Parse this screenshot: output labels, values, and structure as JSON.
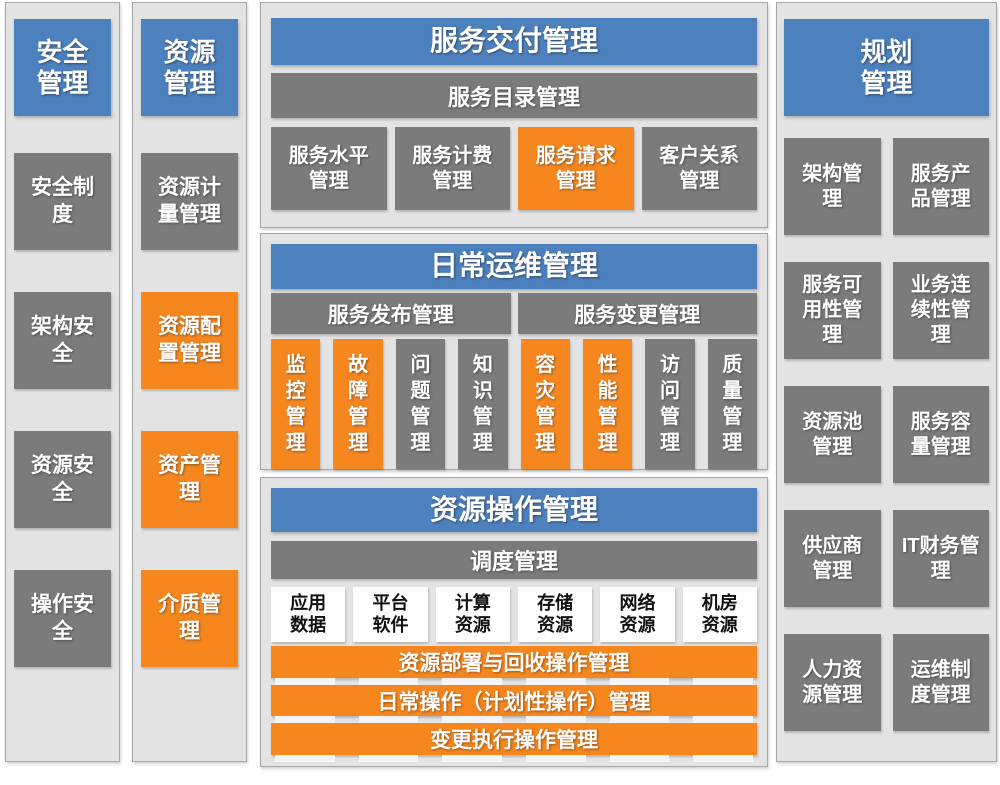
{
  "colors": {
    "blue": "#4D81BE",
    "orange": "#F6871F",
    "gray": "#7B7B7B",
    "panel_bg": "#E3E3E3",
    "panel_border": "#A6A6A6"
  },
  "security": {
    "header": "安全管理",
    "items": [
      {
        "label": "安全制度",
        "color": "gray"
      },
      {
        "label": "架构安全",
        "color": "gray"
      },
      {
        "label": "资源安全",
        "color": "gray"
      },
      {
        "label": "操作安全",
        "color": "gray"
      }
    ]
  },
  "resource": {
    "header": "资源管理",
    "items": [
      {
        "label": "资源计量管理",
        "color": "gray"
      },
      {
        "label": "资源配置管理",
        "color": "orange"
      },
      {
        "label": "资产管理",
        "color": "orange"
      },
      {
        "label": "介质管理",
        "color": "orange"
      }
    ]
  },
  "delivery": {
    "header": "服务交付管理",
    "catalog": "服务目录管理",
    "items": [
      {
        "label": "服务水平管理",
        "color": "gray"
      },
      {
        "label": "服务计费管理",
        "color": "gray"
      },
      {
        "label": "服务请求管理",
        "color": "orange"
      },
      {
        "label": "客户关系管理",
        "color": "gray"
      }
    ]
  },
  "daily": {
    "header": "日常运维管理",
    "bars": [
      {
        "label": "服务发布管理"
      },
      {
        "label": "服务变更管理"
      }
    ],
    "items": [
      {
        "label": "监控管理",
        "color": "orange"
      },
      {
        "label": "故障管理",
        "color": "orange"
      },
      {
        "label": "问题管理",
        "color": "gray"
      },
      {
        "label": "知识管理",
        "color": "gray"
      },
      {
        "label": "容灾管理",
        "color": "orange"
      },
      {
        "label": "性能管理",
        "color": "orange"
      },
      {
        "label": "访问管理",
        "color": "gray"
      },
      {
        "label": "质量管理",
        "color": "gray"
      }
    ]
  },
  "ops": {
    "header": "资源操作管理",
    "schedule": "调度管理",
    "resources": [
      {
        "label": "应用数据"
      },
      {
        "label": "平台软件"
      },
      {
        "label": "计算资源"
      },
      {
        "label": "存储资源"
      },
      {
        "label": "网络资源"
      },
      {
        "label": "机房资源"
      }
    ],
    "bars": [
      {
        "label": "资源部署与回收操作管理"
      },
      {
        "label": "日常操作（计划性操作）管理"
      },
      {
        "label": "变更执行操作管理"
      }
    ]
  },
  "planning": {
    "header": "规划管理",
    "items": [
      {
        "label": "架构管理"
      },
      {
        "label": "服务产品管理"
      },
      {
        "label": "服务可用性管理"
      },
      {
        "label": "业务连续性管理"
      },
      {
        "label": "资源池管理"
      },
      {
        "label": "服务容量管理"
      },
      {
        "label": "供应商管理"
      },
      {
        "label": "IT财务管理"
      },
      {
        "label": "人力资源管理"
      },
      {
        "label": "运维制度管理"
      }
    ]
  }
}
